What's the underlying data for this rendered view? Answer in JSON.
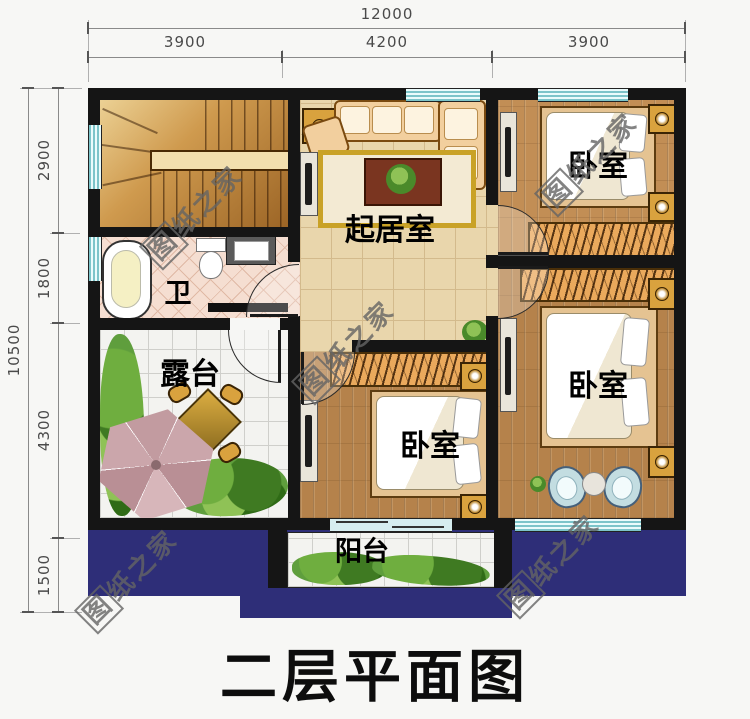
{
  "title": "二层平面图",
  "dimensions": {
    "top": {
      "total": "12000",
      "segments": [
        "3900",
        "4200",
        "3900"
      ]
    },
    "left": {
      "total": "10500",
      "segments": [
        "2900",
        "1800",
        "4300",
        "1500"
      ]
    }
  },
  "rooms": {
    "living_room": "起居室",
    "bedroom": "卧室",
    "bathroom": "卫",
    "terrace": "露台",
    "balcony": "阳台"
  },
  "watermark": {
    "boxed_char": "图",
    "rest": "纸之家",
    "full": "图纸之家"
  },
  "colors": {
    "wall": "#151515",
    "roof_navy": "#2e2e78",
    "wood_floor": "#b5824b",
    "wood_floor_light": "#c28e55",
    "tile_beige": "#e9d6ac",
    "tile_white": "#f3f3f0",
    "bath_tile_pink": "#f5ded1",
    "window_teal": "#7cc4c9",
    "wardrobe_tan": "#eaa95c",
    "dimension_text": "#4a4a4a",
    "watermark_gray": "#8a8a8a",
    "title_black": "#0d0d0d"
  }
}
